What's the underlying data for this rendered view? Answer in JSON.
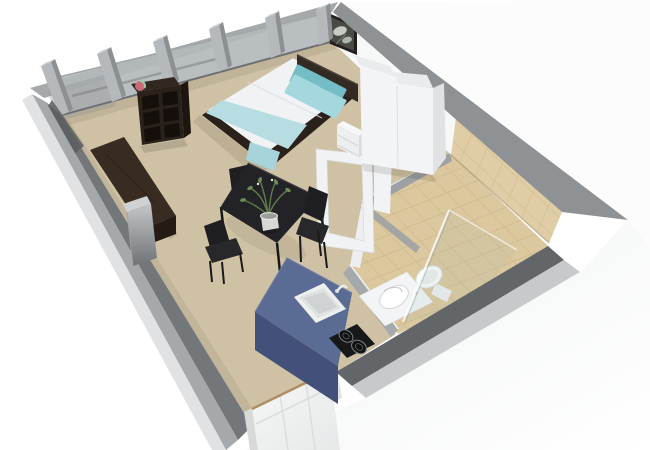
{
  "scene": {
    "title": "3D isometric floor plan render of a studio apartment",
    "background": "#ffffff"
  },
  "colors": {
    "background": "#ffffff",
    "carpet": "#cfc1a4",
    "tile_floor": "#dcc89e",
    "tile_wall": "#e0cda6",
    "tile_line": "#bfa67a",
    "wall_inner": "#74777a",
    "wall_inner_dark": "#5a5d60",
    "wall_top": "#a6a9ab",
    "wall_top_dark": "#8f9294",
    "wall_top_light": "#c7c9ca",
    "wall_white": "#f7f8f8",
    "wall_exterior": "#f4f5f6",
    "partition": "#9ea1a3",
    "glass": "#b3b9bb",
    "glass_shower": "#9fb5b2",
    "pillar": "#b6b9bb",
    "pillar_side": "#8d9092",
    "pillar_cap": "#cdd0d1",
    "counter_top": "#5b6c94",
    "counter_front": "#42507a",
    "counter_side": "#394768",
    "cooktop": "#17181a",
    "kitchen_sink": "#eef0f0",
    "bed_frame": "#2a211b",
    "headboard": "#332a23",
    "duvet": "#f0f2f3",
    "blanket": "#b7dce1",
    "blanket_drape": "#a7d3da",
    "pillow_light": "#a5d8de",
    "pillow_dark": "#74bcc6",
    "wardrobe": "#f3f4f5",
    "wardrobe_side": "#e0e2e4",
    "nightstand": "#eceeef",
    "shelf": "#2a211a",
    "shelf_hole": "#140f0b",
    "sofa": "#382c22",
    "sofa_dark": "#241b14",
    "table": "#232327",
    "chair": "#1f1f22",
    "chair_seat": "#28282b",
    "plant_green": "#5d7d4a",
    "pot": "#d8d9d6",
    "ceramic": "#fbfcfc",
    "ceramic_shade": "#dfe2e2",
    "door": "#f2f3f3",
    "door_frame": "#d8dada",
    "threshold": "#b08d5f",
    "picture_frame": "#241f1c",
    "decor_ball_pink": "#c96a75",
    "decor_ball_green": "#9fc4a8"
  },
  "objects": [
    {
      "name": "window-wall",
      "label": "Glass window wall with pillars"
    },
    {
      "name": "left-wall",
      "label": "Grey side wall"
    },
    {
      "name": "back-wall",
      "label": "White back wall with picture"
    },
    {
      "name": "bottom-wall",
      "label": "Front wall with entry door"
    },
    {
      "name": "entry-door",
      "label": "White panelled entry door"
    },
    {
      "name": "bed",
      "label": "Double bed with teal bedding"
    },
    {
      "name": "nightstand",
      "label": "White bedside drawers"
    },
    {
      "name": "wardrobe",
      "label": "White two-door wardrobe"
    },
    {
      "name": "wall-picture",
      "label": "Framed flower artwork"
    },
    {
      "name": "cube-shelf",
      "label": "Dark cube shelf"
    },
    {
      "name": "sofa",
      "label": "Dark brown sofa bench"
    },
    {
      "name": "side-table",
      "label": "Metal side table"
    },
    {
      "name": "dining-table",
      "label": "Black dining table"
    },
    {
      "name": "dining-chair",
      "label": "Black dining chairs"
    },
    {
      "name": "potted-plant",
      "label": "Green plant in pot"
    },
    {
      "name": "kitchen-counter",
      "label": "Blue kitchen counter"
    },
    {
      "name": "kitchen-sink",
      "label": "Inset kitchen sink"
    },
    {
      "name": "cooktop",
      "label": "Two-ring hob"
    },
    {
      "name": "bathroom",
      "label": "Tiled bathroom"
    },
    {
      "name": "bathroom-door-frame",
      "label": "Open bathroom door frame"
    },
    {
      "name": "washbasin",
      "label": "Washbasin"
    },
    {
      "name": "toilet",
      "label": "Toilet"
    },
    {
      "name": "shower-glass",
      "label": "Glass shower screen"
    }
  ]
}
